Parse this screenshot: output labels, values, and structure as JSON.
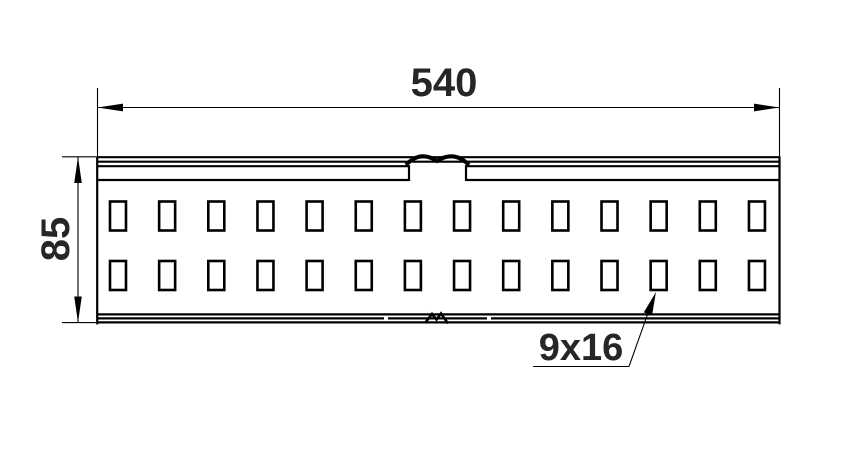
{
  "drawing": {
    "dimensions": {
      "length": {
        "label": "540"
      },
      "height": {
        "label": "85"
      },
      "slot_size": {
        "label": "9x16"
      }
    },
    "colors": {
      "line": "#000000",
      "text": "#262626",
      "background": "#ffffff"
    },
    "slots": {
      "rows": 2,
      "per_row": 14,
      "start_x": 110,
      "pitch": 49.15,
      "width": 16,
      "height": 29,
      "row_y": [
        201.5,
        261
      ],
      "stroke_width": 2.6
    }
  }
}
